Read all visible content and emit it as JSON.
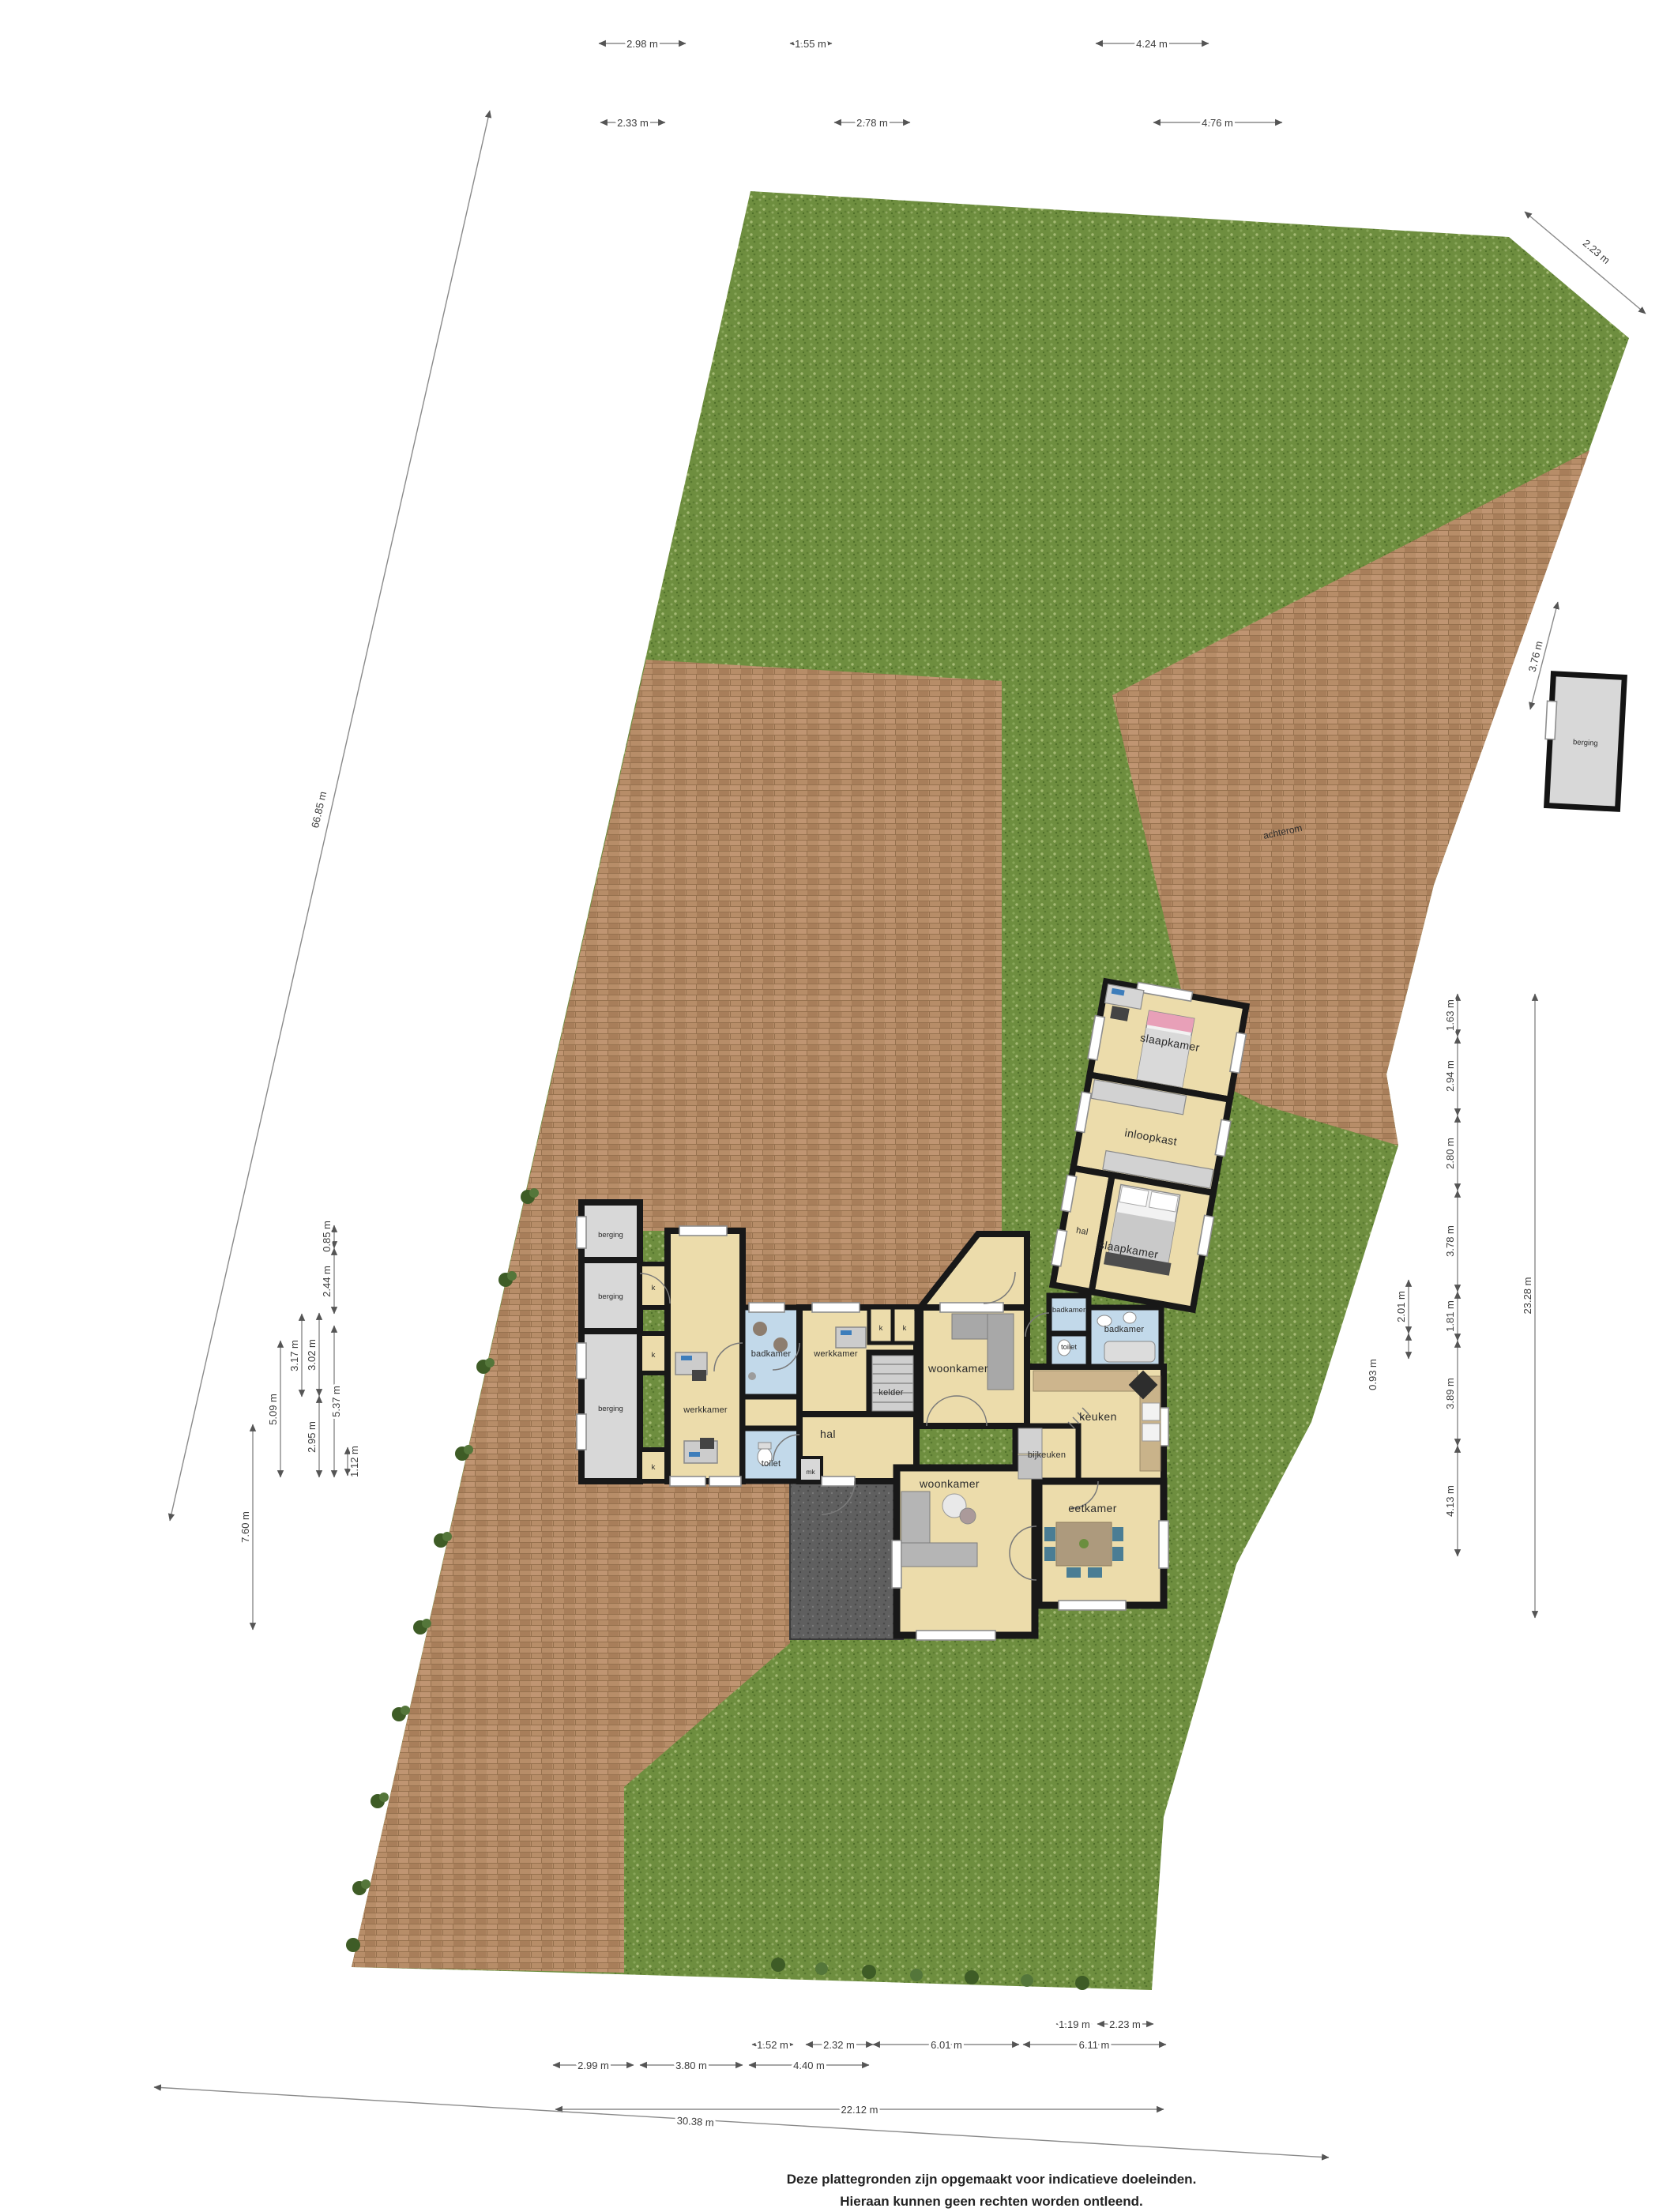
{
  "rooms": {
    "berging_shed": "berging",
    "slaapkamer_top": "slaapkamer",
    "inloopkast": "inloopkast",
    "slaapkamer_mid": "slaapkamer",
    "hal_wing": "hal",
    "badkamer_wing_a": "badkamer",
    "badkamer_wing_b": "badkamer",
    "toilet_wing": "toilet",
    "woonkamer_1": "woonkamer",
    "woonkamer_2": "woonkamer",
    "kelder": "kelder",
    "werkkamer_1": "werkkamer",
    "werkkamer_2": "werkkamer",
    "badkamer_1": "badkamer",
    "toilet_1": "toilet",
    "hal_main": "hal",
    "mk": "mk",
    "k": "k",
    "keuken": "keuken",
    "bijkeuken": "bijkeuken",
    "eetkamer": "eetkamer",
    "berging_1": "berging",
    "berging_2": "berging",
    "berging_3": "berging"
  },
  "site": {
    "path_label": "achterom"
  },
  "dims": {
    "top1": [
      "2.98 m",
      "1.55 m",
      "4.24 m"
    ],
    "top2": [
      "2.33 m",
      "2.78 m",
      "4.76 m"
    ],
    "top_right": "2.23 m",
    "left_boundary": "66.85 m",
    "left": [
      "0.85 m",
      "2.44 m",
      "3.17 m",
      "3.02 m",
      "5.09 m",
      "2.95 m",
      "5.37 m",
      "1.12 m",
      "7.60 m"
    ],
    "right": [
      "1.63 m",
      "2.94 m",
      "2.80 m",
      "3.78 m",
      "1.81 m",
      "3.89 m",
      "4.13 m"
    ],
    "right_total": "23.28 m",
    "right_upper": "3.76 m",
    "right_inner": [
      "2.01 m",
      "0.93 m"
    ],
    "bottom1": [
      "1.19 m",
      "2.23 m"
    ],
    "bottom2": [
      "1.52 m",
      "2.32 m",
      "6.01 m",
      "6.11 m"
    ],
    "bottom3": [
      "2.99 m",
      "3.80 m",
      "4.40 m"
    ],
    "bottom_total": "22.12 m",
    "bottom_boundary": "30.38 m"
  },
  "footer": {
    "line1": "Deze plattegronden zijn opgemaakt voor indicatieve doeleinden.",
    "line2": "Hieraan kunnen geen rechten worden ontleend."
  },
  "colors": {
    "grass": "#6e8e3f",
    "paving": "#b78d68",
    "terrace": "#5f5f5f",
    "floor": "#ecdcab",
    "wet": "#c2d9ea",
    "storage": "#d8d8d8",
    "wall": "#181818"
  }
}
